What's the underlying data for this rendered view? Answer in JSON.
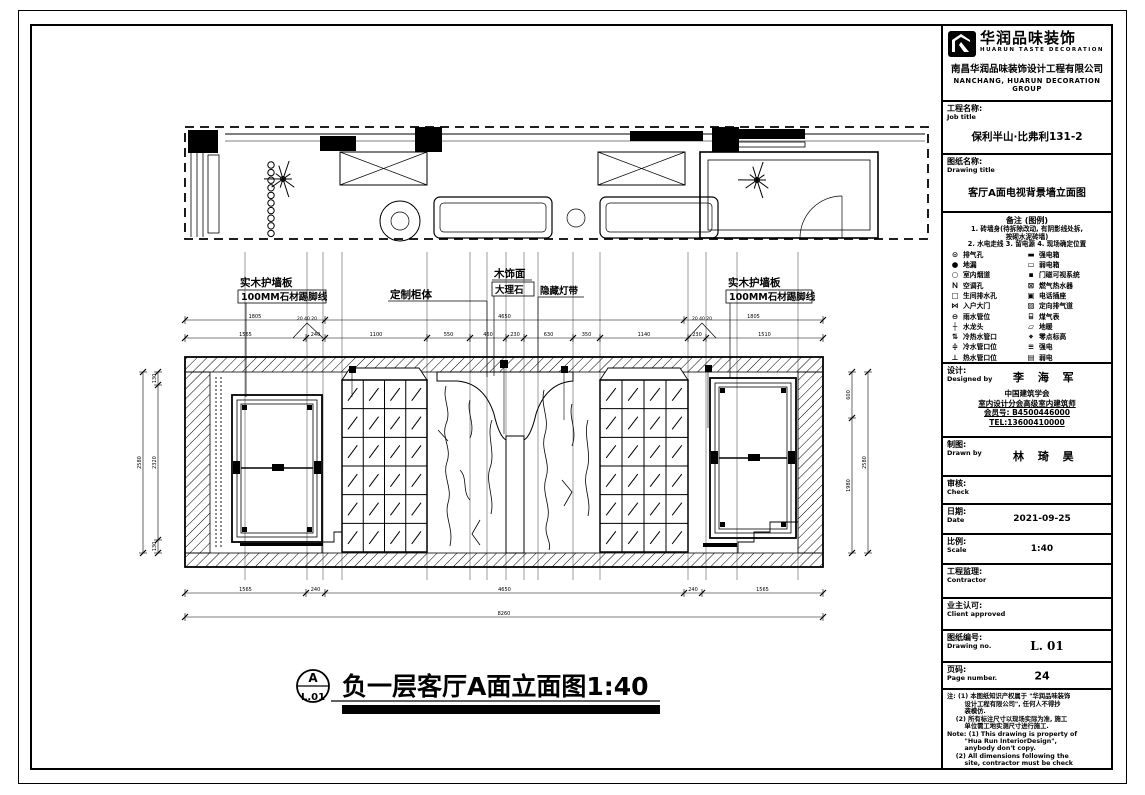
{
  "callouts": {
    "left_wall_panel": "实木护墙板",
    "left_skirting": "100MM石材踢脚线",
    "custom_cabinet": "定制柜体",
    "wood_veneer": "木饰面",
    "marble": "大理石",
    "hidden_light": "隐藏灯带",
    "right_wall_panel": "实木护墙板",
    "right_skirting": "100MM石材踢脚线",
    "y_leader_left": "20 40 20",
    "y_leader_right": "20 40 20"
  },
  "dimensions": {
    "top_segments": [
      "1565",
      "240",
      "1100",
      "550",
      "460",
      "230",
      "630",
      "350",
      "1140",
      "230",
      "1510"
    ],
    "upper_segments": [
      "1805",
      "4650",
      "1805"
    ],
    "bottom_segments": [
      "1565",
      "240",
      "4650",
      "240",
      "1565"
    ],
    "bottom_total": "8260",
    "left_segments": [
      "130",
      "2320",
      "130"
    ],
    "left_total": "2580",
    "right_segments": [
      "600",
      "1980"
    ],
    "right_total": "2580"
  },
  "drawing_label": {
    "marker_letter": "A",
    "marker_sheet": "L.01",
    "title": "负一层客厅A面立面图1:40"
  },
  "titleblock": {
    "logo": {
      "brand_cn": "华润品味装饰",
      "brand_en": "HUARUN TASTE DECORATION",
      "company_cn": "南昌华润品味装饰设计工程有限公司",
      "company_en": "NANCHANG, HUARUN DECORATION GROUP"
    },
    "job": {
      "label_cn": "工程名称:",
      "label_en": "Job title",
      "value": "保利半山·比弗利131-2"
    },
    "drawing": {
      "label_cn": "图纸名称:",
      "label_en": "Drawing title",
      "value": "客厅A面电视背景墙立面图"
    },
    "legend": {
      "title": "备注 (图例)",
      "notes": [
        "1. 砖墙身(待拆除改动, 有阴影线处拆,",
        "按砌水泥砖墙)",
        "2. 水电走线 3. 留电源 4. 现场确定位置"
      ],
      "rows": [
        {
          "ls": "⊙",
          "ll": "排气孔",
          "rs": "▬",
          "rl": "强电箱"
        },
        {
          "ls": "●",
          "ll": "地漏",
          "rs": "▭",
          "rl": "弱电箱"
        },
        {
          "ls": "○",
          "ll": "室内烟道",
          "rs": "▪",
          "rl": "门磁可视系统"
        },
        {
          "ls": "Ｎ",
          "ll": "空调孔",
          "rs": "⊠",
          "rl": "燃气热水器"
        },
        {
          "ls": "□",
          "ll": "生间排水孔",
          "rs": "▣",
          "rl": "电话插座"
        },
        {
          "ls": "⋈",
          "ll": "入户大门",
          "rs": "▨",
          "rl": "定向排气道"
        },
        {
          "ls": "⊖",
          "ll": "雨水管位",
          "rs": "⌸",
          "rl": "煤气表"
        },
        {
          "ls": "┼",
          "ll": "水龙头",
          "rs": "▱",
          "rl": "地暖"
        },
        {
          "ls": "⇅",
          "ll": "冷热水管口",
          "rs": "⌖",
          "rl": "零点标高"
        },
        {
          "ls": "≑",
          "ll": "冷水管口位",
          "rs": "≡",
          "rl": "强电"
        },
        {
          "ls": "⊥",
          "ll": "热水管口位",
          "rs": "▤",
          "rl": "弱电"
        }
      ]
    },
    "designed": {
      "label_cn": "设计:",
      "label_en": "Designed by",
      "name": "李 海 军",
      "org1": "中国建筑学会",
      "org2": "室内设计分会高级室内建筑师",
      "member": "会员号: B4500446000",
      "tel": "TEL:13600410000"
    },
    "drawn": {
      "label_cn": "制图:",
      "label_en": "Drawn by",
      "name": "林 琦 昊"
    },
    "check": {
      "label_cn": "审核:",
      "label_en": "Check",
      "value": ""
    },
    "date": {
      "label_cn": "日期:",
      "label_en": "Date",
      "value": "2021-09-25"
    },
    "scale": {
      "label_cn": "比例:",
      "label_en": "Scale",
      "value": "1:40"
    },
    "contractor": {
      "label_cn": "工程监理:",
      "label_en": "Contractor",
      "value": ""
    },
    "client": {
      "label_cn": "业主认可:",
      "label_en": "Client approved",
      "value": ""
    },
    "drawing_no": {
      "label_cn": "图纸编号:",
      "label_en": "Drawing no.",
      "value": "L. 01"
    },
    "page": {
      "label_cn": "页码:",
      "label_en": "Page number.",
      "value": "24"
    },
    "notes": {
      "lines": [
        "注: (1) 本图纸知识产权属于 \"华润品味装饰",
        "        设计工程有限公司\", 任何人不得抄",
        "        袭模仿.",
        "    (2) 所有标注尺寸以现场实际为准, 施工",
        "        单位需工地实测尺寸进行施工.",
        "Note: (1) This drawing is property of",
        "        \"Hua Run InteriorDesign\",",
        "        anybody don't copy.",
        "    (2) All dimensions following the",
        "        site, contractor must be check"
      ]
    }
  }
}
